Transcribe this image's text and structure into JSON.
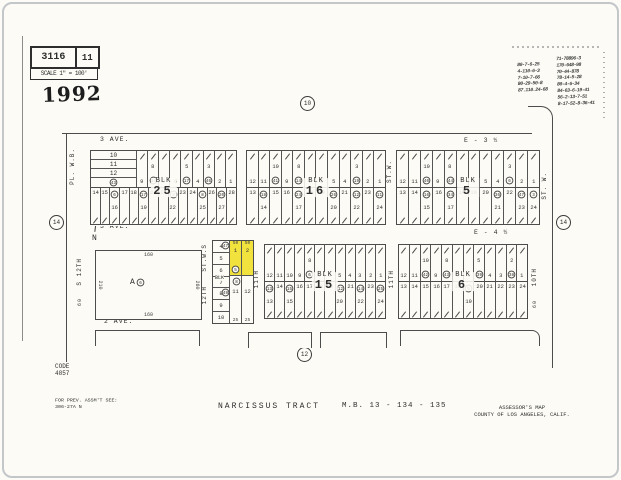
{
  "colors": {
    "highlight": "#f2e23e",
    "paper": "#fcfbf5",
    "ink": "#2e2e2e"
  },
  "header": {
    "sheet": "3116",
    "page": "11",
    "scale": "SCALE 1\" = 100'",
    "year": "1992",
    "north": "N"
  },
  "stamp": {
    "left": [
      "80-7-6-25",
      "4-110-6-3",
      "7-10-7-66",
      "80-29-50-8",
      "87.110.24-68"
    ],
    "right": [
      "71-78896-3",
      "170-648-98",
      "70-44-878",
      "78-14-5-28",
      "80-4-6-34",
      "84-63-6-19-41",
      "56-2-13-7-51",
      "8-17-52-8-36-41"
    ]
  },
  "junctions": {
    "top": "10",
    "left": "14",
    "right": "14",
    "bottom": "12"
  },
  "avenues": [
    {
      "left": "3 AVE.",
      "right": "E - 3 ½"
    },
    {
      "left": "3 AVE.",
      "right": "E - 4 ½"
    },
    {
      "left": "2 AVE.",
      "right": "E - 5 ½"
    }
  ],
  "vstreets": {
    "pl_wb": "PL. W.B.",
    "stw_mid": "ST.W.",
    "stw_right": "ST. W.",
    "s12": "S 12TH",
    "s12_dim": "60",
    "stws": "ST.W.S",
    "t12": "12TH",
    "t11_left": "11TH",
    "t11_right": "11TH",
    "t10": "10TH",
    "t10_dim": "60"
  },
  "parcel_a": {
    "label": "A",
    "circle": "6",
    "dim_top": "160",
    "dim_bottom": "160",
    "dim_left": "210",
    "dim_right": "260"
  },
  "small_block": {
    "blk": "BLK",
    "left": {
      "cells": [
        "4",
        "5",
        "6",
        "7",
        "8",
        "9",
        "10"
      ],
      "circles": {
        "4": "47",
        "8": "49"
      }
    },
    "yellow": {
      "cells": [
        "1",
        "2"
      ],
      "circle": "5",
      "dims": [
        "50",
        "50"
      ]
    },
    "lower": {
      "cells": [
        "11",
        "12"
      ],
      "circle": "8",
      "dims": [
        "25",
        "25"
      ]
    }
  },
  "blocks": [
    {
      "name": "25",
      "blk": "BLK",
      "num": "25",
      "minicol": {
        "cells": [
          "10",
          "11",
          "12"
        ],
        "circle": "43"
      },
      "top": {
        "cells": [
          "9",
          "8",
          "7",
          "6",
          "5",
          "4",
          "3",
          "2",
          "1"
        ],
        "circles": {
          "8": "44",
          "5": "17",
          "3": "46"
        }
      },
      "bottom": {
        "cells": [
          "14",
          "15",
          "16",
          "17",
          "18",
          "19",
          "20",
          "21",
          "22",
          "23",
          "24",
          "25",
          "26",
          "27",
          "28"
        ],
        "circles": {
          "16": "6",
          "19": "17",
          "22": "8",
          "25": "8",
          "27": "20"
        }
      }
    },
    {
      "name": "16",
      "blk": "BLK",
      "num": "16",
      "top": {
        "cells": [
          "12",
          "11",
          "10",
          "9",
          "8",
          "7",
          "6",
          "5",
          "4",
          "3",
          "2",
          "1"
        ],
        "circles": {
          "10": "41",
          "8": "14",
          "3": "19"
        }
      },
      "bottom": {
        "cells": [
          "13",
          "14",
          "15",
          "16",
          "17",
          "18",
          "19",
          "20",
          "21",
          "22",
          "23",
          "24"
        ],
        "circles": {
          "14": "18",
          "17": "24",
          "20": "26",
          "22": "12",
          "24": "11"
        }
      }
    },
    {
      "name": "5",
      "blk": "BLK",
      "num": "5",
      "top": {
        "cells": [
          "12",
          "11",
          "10",
          "9",
          "8",
          "7",
          "6",
          "5",
          "4",
          "3",
          "2",
          "1"
        ],
        "circles": {
          "10": "40",
          "8": "44",
          "3": "6"
        }
      },
      "bottom": {
        "cells": [
          "13",
          "14",
          "15",
          "16",
          "17",
          "18",
          "19",
          "20",
          "21",
          "22",
          "23",
          "24"
        ],
        "circles": {
          "15": "16",
          "17": "34",
          "21": "36",
          "23": "47",
          "24": "3"
        }
      }
    },
    {
      "name": "15",
      "blk": "BLK",
      "num": "15",
      "top": {
        "cells": [
          "12",
          "11",
          "10",
          "9",
          "8",
          "7",
          "6",
          "5",
          "4",
          "3",
          "2",
          "1"
        ],
        "circles": {
          "8": "6"
        }
      },
      "bottom": {
        "cells": [
          "13",
          "14",
          "15",
          "16",
          "17",
          "18",
          "19",
          "20",
          "21",
          "22",
          "23",
          "24"
        ],
        "circles": {
          "13": "13",
          "15": "15",
          "20": "12",
          "22": "14",
          "24": "25"
        }
      }
    },
    {
      "name": "6",
      "blk": "BLK",
      "num": "6",
      "top": {
        "cells": [
          "12",
          "11",
          "10",
          "9",
          "8",
          "7",
          "6",
          "5",
          "4",
          "3",
          "2",
          "1"
        ],
        "circles": {
          "10": "42",
          "8": "43",
          "5": "39",
          "2": "38"
        }
      },
      "bottom": {
        "cells": [
          "13",
          "14",
          "15",
          "16",
          "17",
          "18",
          "19",
          "20",
          "21",
          "22",
          "23",
          "24"
        ],
        "circles": {
          "19": "5"
        }
      }
    }
  ],
  "footer": {
    "code_label": "CODE",
    "code_value": "4857",
    "prev1": "FOR PREV. ASSM'T SEE:",
    "prev2": "306-27A N",
    "tract": "NARCISSUS TRACT",
    "map_book": "M.B. 13 - 134 - 135",
    "assessor1": "ASSESSOR'S MAP",
    "assessor2": "COUNTY OF LOS ANGELES, CALIF."
  }
}
